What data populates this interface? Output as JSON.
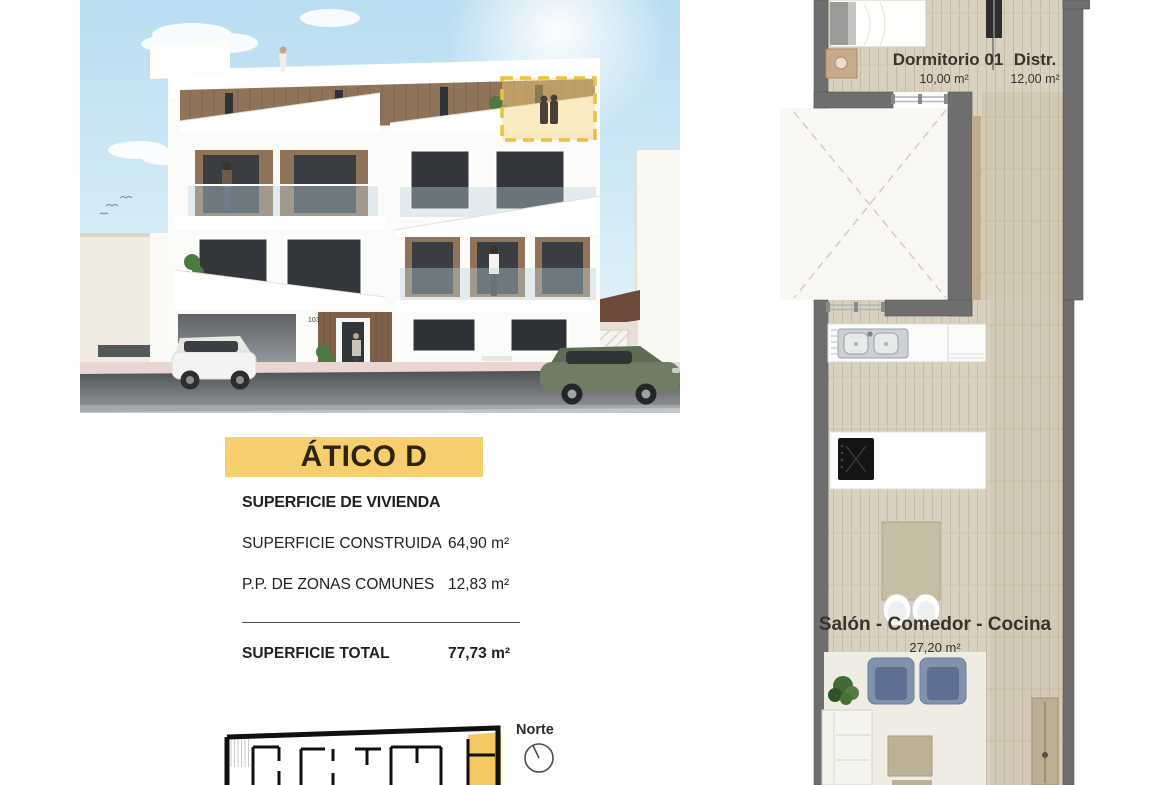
{
  "unit": {
    "title": "ÁTICO D"
  },
  "surface_table": {
    "header": "SUPERFICIE DE VIVIENDA",
    "rows": [
      {
        "label": "SUPERFICIE CONSTRUIDA",
        "value": "64,90 m²"
      },
      {
        "label": "P.P. DE ZONAS COMUNES",
        "value": "12,83 m²"
      }
    ],
    "total_label": "SUPERFICIE TOTAL",
    "total_value": "77,73 m²"
  },
  "compass": {
    "label": "Norte"
  },
  "floor_plan": {
    "rooms": [
      {
        "name": "Dormitorio 01",
        "area": "10,00 m²"
      },
      {
        "name": "Distr.",
        "area": "12,00 m²"
      },
      {
        "name": "Salón - Comedor - Cocina",
        "area": "27,20 m²"
      }
    ]
  },
  "entrance": {
    "number": "103"
  },
  "colors": {
    "banner_yellow": "#F6CE6D",
    "highlight_yellow": "#E9C23F",
    "wall_gray": "#6E6E6E",
    "wood_floor": "#D9D0C0"
  }
}
